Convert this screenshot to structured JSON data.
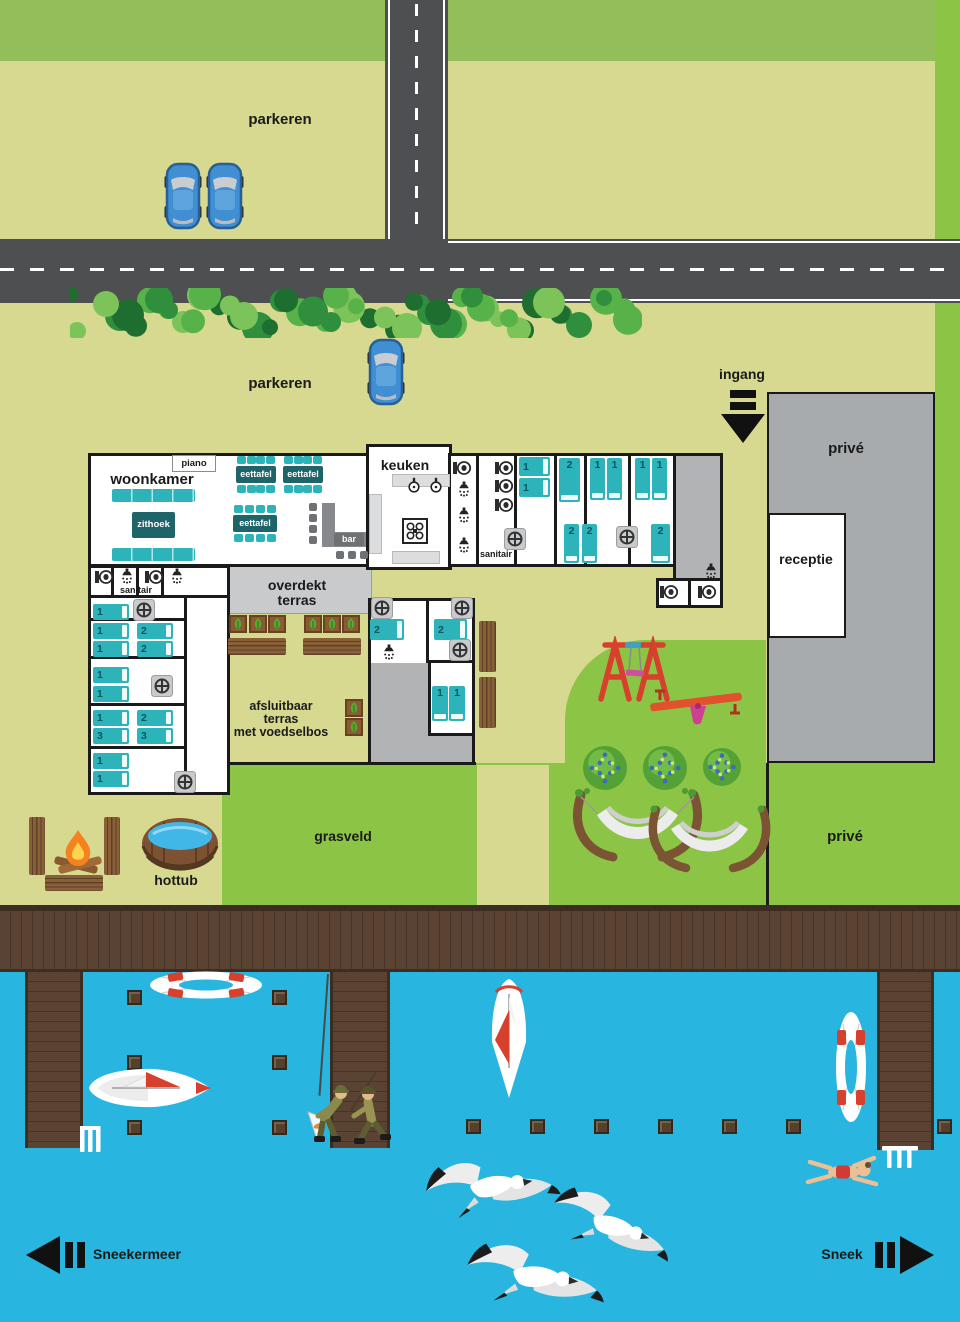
{
  "labels": {
    "parkeren_top": "parkeren",
    "parkeren_mid": "parkeren",
    "ingang": "ingang",
    "prive_top": "privé",
    "receptie": "receptie",
    "prive_bottom": "privé",
    "grasveld": "grasveld",
    "hottub": "hottub",
    "sneekermeer": "Sneekermeer",
    "sneek": "Sneek",
    "woonkamer": "woonkamer",
    "piano": "piano",
    "zithoek": "zithoek",
    "eettafel": "eettafel",
    "bar": "bar",
    "keuken": "keuken",
    "sanitair_left": "sanitair",
    "sanitair_mid": "sanitair",
    "overdekt_1": "overdekt",
    "overdekt_2": "terras",
    "afsluitbaar_1": "afsluitbaar",
    "afsluitbaar_2": "terras",
    "afsluitbaar_3": "met voedselbos"
  },
  "colors": {
    "field_pale": "#d6d98f",
    "grass_green": "#8cc446",
    "band_green": "#93bf5a",
    "road_gray": "#4e4f51",
    "water_blue": "#28b5e0",
    "wood_brown": "#5a4332",
    "teal": "#2db4bb",
    "dark_teal": "#1e6468",
    "prive_gray": "#a8abad",
    "terrace_gray": "#c9cacc",
    "corridor_gray": "#b1b3b5",
    "play_red": "#d7402c",
    "accent_pink": "#cf4f9e"
  },
  "icons": {
    "toilet": "toilet-icon",
    "shower": "shower-icon",
    "sink": "sink-icon",
    "washer": "washing-machine-icon",
    "stove": "stove-icon",
    "bed": "bed",
    "arrow": "direction-arrow-icon"
  },
  "map": {
    "beds": [
      [
        93,
        604,
        36,
        16,
        "h",
        "1"
      ],
      [
        93,
        623,
        36,
        16,
        "h",
        "1"
      ],
      [
        137,
        623,
        36,
        16,
        "h",
        "2"
      ],
      [
        93,
        641,
        36,
        16,
        "h",
        "1"
      ],
      [
        137,
        641,
        36,
        16,
        "h",
        "2"
      ],
      [
        93,
        667,
        36,
        16,
        "h",
        "1"
      ],
      [
        93,
        686,
        36,
        16,
        "h",
        "1"
      ],
      [
        93,
        710,
        36,
        16,
        "h",
        "1"
      ],
      [
        137,
        710,
        36,
        16,
        "h",
        "2"
      ],
      [
        93,
        728,
        36,
        16,
        "h",
        "3"
      ],
      [
        137,
        728,
        36,
        16,
        "h",
        "3"
      ],
      [
        93,
        753,
        36,
        16,
        "h",
        "1"
      ],
      [
        93,
        771,
        36,
        16,
        "h",
        "1"
      ],
      [
        519,
        457,
        31,
        19,
        "h",
        "1"
      ],
      [
        519,
        478,
        31,
        19,
        "h",
        "1"
      ],
      [
        559,
        458,
        21,
        44,
        "v",
        "2"
      ],
      [
        590,
        458,
        15,
        42,
        "v",
        "1"
      ],
      [
        607,
        458,
        15,
        42,
        "v",
        "1"
      ],
      [
        635,
        458,
        15,
        42,
        "v",
        "1"
      ],
      [
        652,
        458,
        15,
        42,
        "v",
        "1"
      ],
      [
        564,
        524,
        15,
        39,
        "v",
        "2"
      ],
      [
        582,
        524,
        15,
        39,
        "v",
        "2"
      ],
      [
        651,
        524,
        19,
        39,
        "v",
        "2"
      ],
      [
        370,
        619,
        34,
        21,
        "h",
        "2"
      ],
      [
        434,
        619,
        33,
        21,
        "h",
        "2"
      ],
      [
        432,
        686,
        16,
        35,
        "v",
        "1"
      ],
      [
        449,
        686,
        16,
        35,
        "v",
        "1"
      ]
    ],
    "toilets": [
      [
        94,
        569
      ],
      [
        144,
        569
      ],
      [
        452,
        460
      ],
      [
        494,
        460
      ],
      [
        494,
        478
      ],
      [
        494,
        497
      ],
      [
        659,
        584
      ],
      [
        697,
        584
      ]
    ],
    "showers": [
      [
        119,
        568
      ],
      [
        169,
        568
      ],
      [
        456,
        481
      ],
      [
        456,
        507
      ],
      [
        456,
        537
      ],
      [
        381,
        644
      ],
      [
        703,
        563
      ]
    ],
    "sinks": [
      [
        406,
        477
      ],
      [
        428,
        477
      ]
    ],
    "washers": [
      [
        133,
        599
      ],
      [
        151,
        675
      ],
      [
        174,
        771
      ],
      [
        504,
        528
      ],
      [
        616,
        526
      ],
      [
        371,
        597
      ],
      [
        451,
        597
      ],
      [
        449,
        639
      ]
    ],
    "tables": [
      [
        236,
        466,
        40,
        17
      ],
      [
        283,
        466,
        40,
        17
      ],
      [
        233,
        515,
        44,
        17
      ]
    ],
    "sofas": [
      [
        112,
        489,
        83,
        13
      ],
      [
        112,
        548,
        83,
        13
      ]
    ],
    "stools": [
      [
        309,
        503
      ],
      [
        309,
        514
      ],
      [
        309,
        525
      ],
      [
        309,
        536
      ],
      [
        336,
        551
      ],
      [
        348,
        551
      ],
      [
        360,
        551
      ]
    ],
    "planters": [
      [
        229,
        615
      ],
      [
        249,
        615
      ],
      [
        268,
        615
      ],
      [
        304,
        615
      ],
      [
        323,
        615
      ],
      [
        342,
        615
      ],
      [
        345,
        699
      ],
      [
        345,
        718
      ]
    ],
    "picnic_h": [
      [
        228,
        638,
        58,
        17
      ],
      [
        303,
        638,
        58,
        17
      ],
      [
        45,
        875,
        58,
        16
      ]
    ],
    "picnic_v": [
      [
        479,
        621,
        17,
        51
      ],
      [
        479,
        677,
        17,
        51
      ],
      [
        29,
        817,
        16,
        58
      ],
      [
        104,
        817,
        16,
        58
      ]
    ],
    "posts": [
      [
        127,
        990
      ],
      [
        272,
        990
      ],
      [
        127,
        1055
      ],
      [
        272,
        1055
      ],
      [
        127,
        1120
      ],
      [
        272,
        1120
      ],
      [
        466,
        1119
      ],
      [
        530,
        1119
      ],
      [
        594,
        1119
      ],
      [
        658,
        1119
      ],
      [
        722,
        1119
      ],
      [
        786,
        1119
      ],
      [
        937,
        1119
      ]
    ],
    "bushes": [
      [
        583,
        746,
        44
      ],
      [
        643,
        746,
        44
      ],
      [
        703,
        748,
        38
      ]
    ],
    "cars": [
      [
        164,
        160
      ],
      [
        206,
        160
      ],
      [
        367,
        336
      ]
    ],
    "hedge": [
      70,
      288,
      572,
      50
    ],
    "gulls": [
      [
        420,
        1148,
        1,
        -12
      ],
      [
        538,
        1186,
        0.95,
        14
      ],
      [
        462,
        1238,
        1.05,
        2
      ]
    ]
  }
}
